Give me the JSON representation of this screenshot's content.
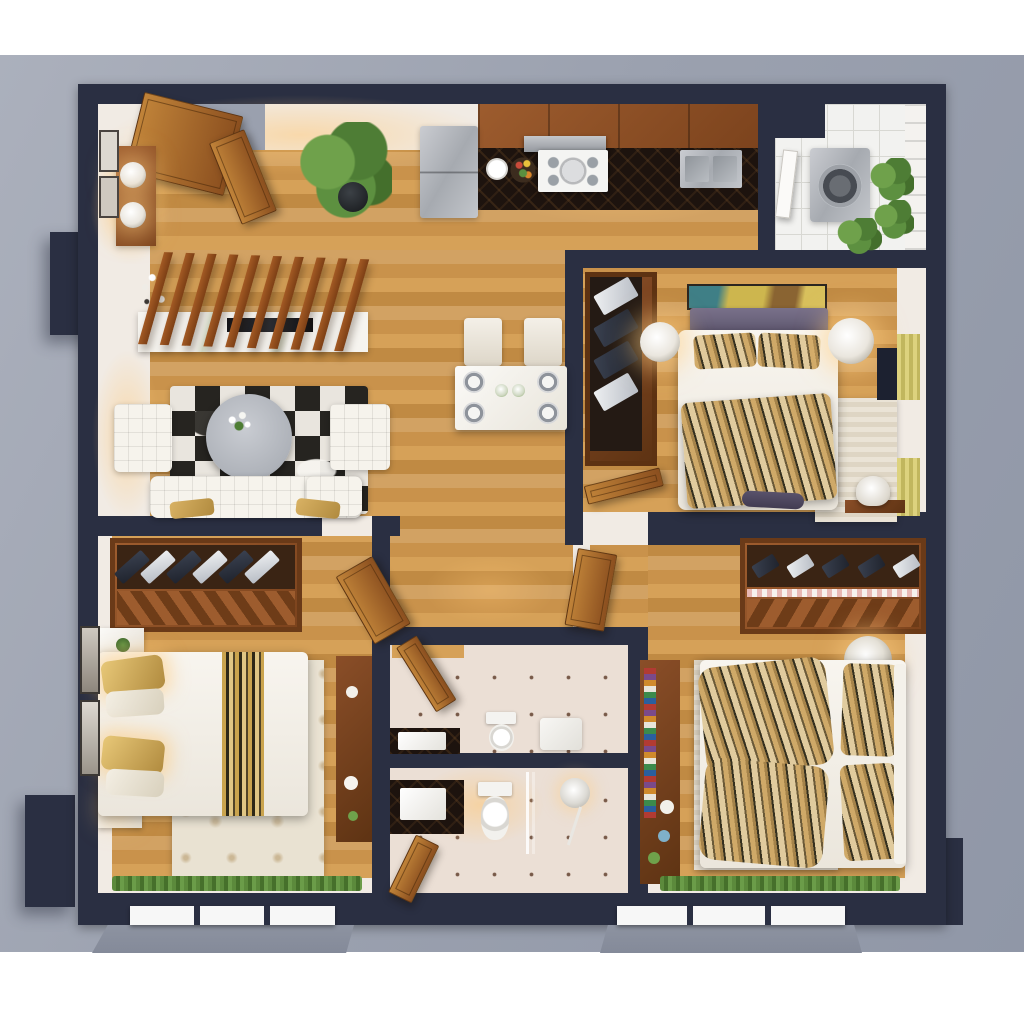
{
  "meta": {
    "title": "3D top-down apartment floor plan render — three bedrooms, two bathrooms, open living/kitchen/dining, laundry balcony",
    "view": "isometric top-down dollhouse render",
    "text_on_screen": "none"
  },
  "palette": {
    "page_bg": "#ffffff",
    "backdrop": "#9ba1af",
    "backdrop_light": "#abb0bc",
    "backdrop_shade": "#9097a7",
    "balcony_gray": "#8d93a1",
    "wall": "#2a2f42",
    "interior_white": "#f1ebe4",
    "wood_light": "#d6a158",
    "wood_mid": "#c9924b",
    "counter_stone": "#1d130e",
    "steel": "#b8bcc2",
    "linen": "#f5f2ec",
    "purple_headboard": "#6e6880",
    "print_tan": "#cfa968",
    "print_dark": "#35301f",
    "rug_ornate": "#e9e2d2",
    "cowhide_dark": "#262420",
    "cowhide_light": "#e9e5de",
    "tile_bath": "#ebdfd5",
    "tile_laundry": "#f2f2f0",
    "railing_white": "#f4f2ef",
    "green_plant": "#6fa14b",
    "green_grass": "#5c8a3c",
    "curtain_yellow": "#ddd27e",
    "glow_warm": "rgba(255,205,130,0.55)",
    "frame_white": "#f7f7f7"
  },
  "rooms": [
    {
      "id": "entry-hall",
      "name": "Entry hall",
      "furniture": [
        "double-entry-doors",
        "console-table",
        "table-lamps",
        "wall-frames",
        "potted-palm"
      ]
    },
    {
      "id": "living-room",
      "name": "Living room",
      "furniture": [
        "slatted-wood-divider",
        "marble-media-console",
        "fireplace-inset",
        "branch-vase",
        "cowhide-rug",
        "round-coffee-table",
        "ottoman-left",
        "ottoman-right",
        "sofa-with-pillows"
      ]
    },
    {
      "id": "dining-area",
      "name": "Dining area",
      "furniture": [
        "dining-table",
        "dining-chairs-x4",
        "place-settings"
      ]
    },
    {
      "id": "kitchen",
      "name": "Kitchen",
      "furniture": [
        "refrigerator",
        "upper-cabinets",
        "range-hood",
        "cooktop",
        "stone-countertop",
        "double-sink",
        "fruit-bowl",
        "serving-plate"
      ]
    },
    {
      "id": "laundry-balcony",
      "name": "Laundry balcony",
      "furniture": [
        "washing-machine",
        "service-shaft",
        "balcony-door",
        "plants",
        "balcony-railing"
      ]
    },
    {
      "id": "bedroom-master",
      "name": "Master bedroom (top right)",
      "furniture": [
        "open-wardrobe-with-clothes",
        "wall-art",
        "upholstered-headboard",
        "double-bed",
        "print-blanket",
        "bedside-lamps-x2",
        "striped-rug",
        "desk",
        "desk-chair",
        "tv-panel",
        "yellow-curtains",
        "room-door"
      ]
    },
    {
      "id": "bedroom-left",
      "name": "Bedroom (bottom left)",
      "furniture": [
        "open-wardrobe-rack",
        "room-door",
        "nightstands-x2",
        "bed-with-gold-runner",
        "ornate-rug",
        "dresser",
        "wall-frames",
        "window-plants"
      ]
    },
    {
      "id": "bedroom-right",
      "name": "Bedroom (bottom right)",
      "furniture": [
        "open-wardrobe-rack",
        "room-door",
        "bookshelf",
        "bed-with-print-blanket",
        "print-pillows",
        "striped-rug",
        "bowl-lamp",
        "window-plants"
      ]
    },
    {
      "id": "bathroom-top",
      "name": "Bathroom 1",
      "furniture": [
        "door",
        "vanity-sink",
        "toilet",
        "shower-tray"
      ]
    },
    {
      "id": "bathroom-bottom",
      "name": "Bathroom 2",
      "furniture": [
        "door",
        "vanity-sink",
        "toilet",
        "rain-shower",
        "glass-screen"
      ]
    }
  ],
  "exterior": {
    "balconies": [
      "bottom-left-balcony-slab",
      "bottom-right-balcony-slab"
    ],
    "window_frames": [
      "bottom-left-sliding-door",
      "bottom-right-sliding-door"
    ],
    "structural": [
      "left-wall-pillar",
      "bottom-left-column",
      "right-wall-block",
      "utility-shaft"
    ]
  }
}
